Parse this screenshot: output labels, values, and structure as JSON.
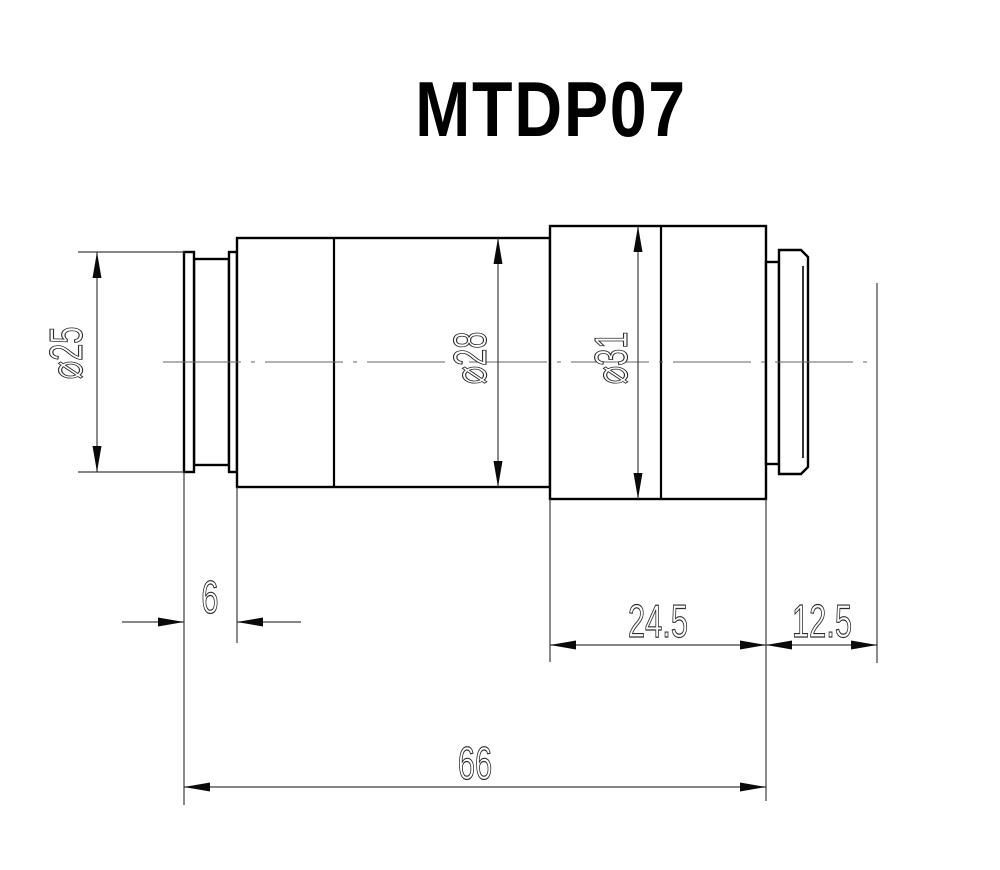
{
  "title": "MTDP07",
  "dimensions": {
    "front_diameter": "⌀25",
    "body_diameter": "⌀28",
    "rear_diameter": "⌀31",
    "front_flange_length": "6",
    "rear_section_length": "24.5",
    "mount_length": "12.5",
    "overall_length": "66"
  },
  "colors": {
    "outline": "#000000",
    "dimension_lines": "#3d3d3d",
    "centerline": "#666666",
    "background": "#ffffff"
  }
}
